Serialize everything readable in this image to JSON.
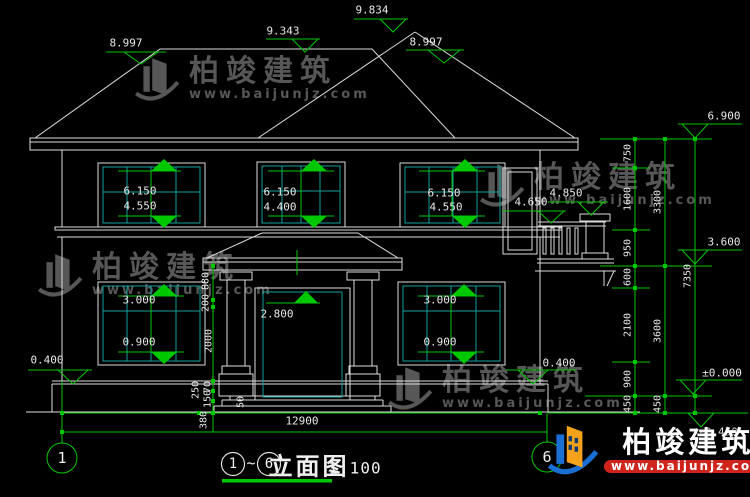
{
  "title": {
    "axis_from": "1",
    "separator": "~",
    "axis_to": "6",
    "name": "立面图",
    "scale": "1:100"
  },
  "axes": {
    "left_bubble": "1",
    "right_bubble": "6"
  },
  "elevations": {
    "roof_left_eave": "8.997",
    "roof_left_ridge": "9.343",
    "roof_right_ridge": "9.834",
    "roof_right_eave": "8.997",
    "right_eave": "6.900",
    "right_floor2": "3.600",
    "right_ground": "±0.000",
    "right_base": "-0.450",
    "plinth_left": "0.400",
    "plinth_right": "0.400",
    "balcony_rail": "4.650",
    "balcony_pillar": "4.850"
  },
  "windows": {
    "f2_left_head": "6.150",
    "f2_left_sill": "4.550",
    "f2_mid_head": "6.150",
    "f2_mid_sill": "4.400",
    "f2_right_head": "6.150",
    "f2_right_sill": "4.550",
    "f1_left_head": "3.000",
    "f1_left_sill": "0.900",
    "f1_right_head": "3.000",
    "f1_right_sill": "0.900",
    "door_head": "2.800"
  },
  "dims": {
    "right_inner": [
      "750",
      "1600",
      "950",
      "600",
      "2100",
      "900",
      "450"
    ],
    "right_mid": [
      "3300",
      "3600",
      "450"
    ],
    "right_outer": [
      "7350"
    ],
    "entry": [
      "880",
      "200",
      "2000",
      "250",
      "70",
      "150",
      "50"
    ],
    "bottom_left": "380",
    "bottom_total": "12900"
  },
  "watermark": {
    "brand": "柏竣建筑",
    "url": "www.baijunjz.com"
  },
  "logo": {
    "brand": "柏竣建筑",
    "url": "www.baijunjz.com"
  }
}
